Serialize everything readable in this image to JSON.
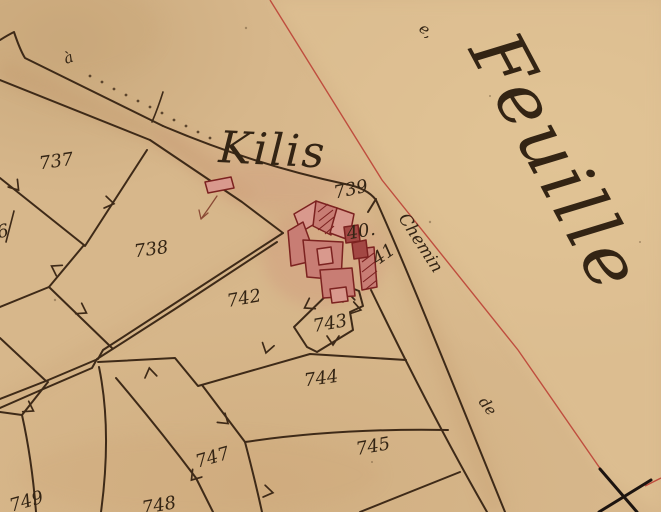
{
  "title": "Hand-drawn cadastral map sheet",
  "texts": {
    "sheet_label": "Feuille",
    "sheet_label_prefix": "e,",
    "place_name": "Kilis",
    "road_label": "Chemin",
    "road_label_2": "de",
    "annotation": "à"
  },
  "parcels": [
    {
      "id": "737",
      "text": "737"
    },
    {
      "id": "738",
      "text": "738"
    },
    {
      "id": "739",
      "text": "739"
    },
    {
      "id": "740",
      "text": "40."
    },
    {
      "id": "741",
      "text": "41"
    },
    {
      "id": "742",
      "text": "742"
    },
    {
      "id": "743",
      "text": "743"
    },
    {
      "id": "744",
      "text": "744"
    },
    {
      "id": "745",
      "text": "745"
    },
    {
      "id": "747",
      "text": "747"
    },
    {
      "id": "748",
      "text": "748"
    },
    {
      "id": "749",
      "text": "749"
    },
    {
      "id": "partial-6",
      "text": "6"
    }
  ],
  "colors": {
    "paper": "#d7b78b",
    "paper_shade": "#c6a274",
    "paper_light": "#e0c498",
    "ink": "#3e2a18",
    "text": "#332414",
    "building_light": "#d9998d",
    "building_rose": "#c87d74",
    "building_dark": "#b25a52",
    "building_deep": "#a34844",
    "building_outline": "#7c2220",
    "sheet_line_red": "#bf4d3e",
    "cross_black": "#1c1410",
    "arrow_brown": "#8a4a35"
  }
}
